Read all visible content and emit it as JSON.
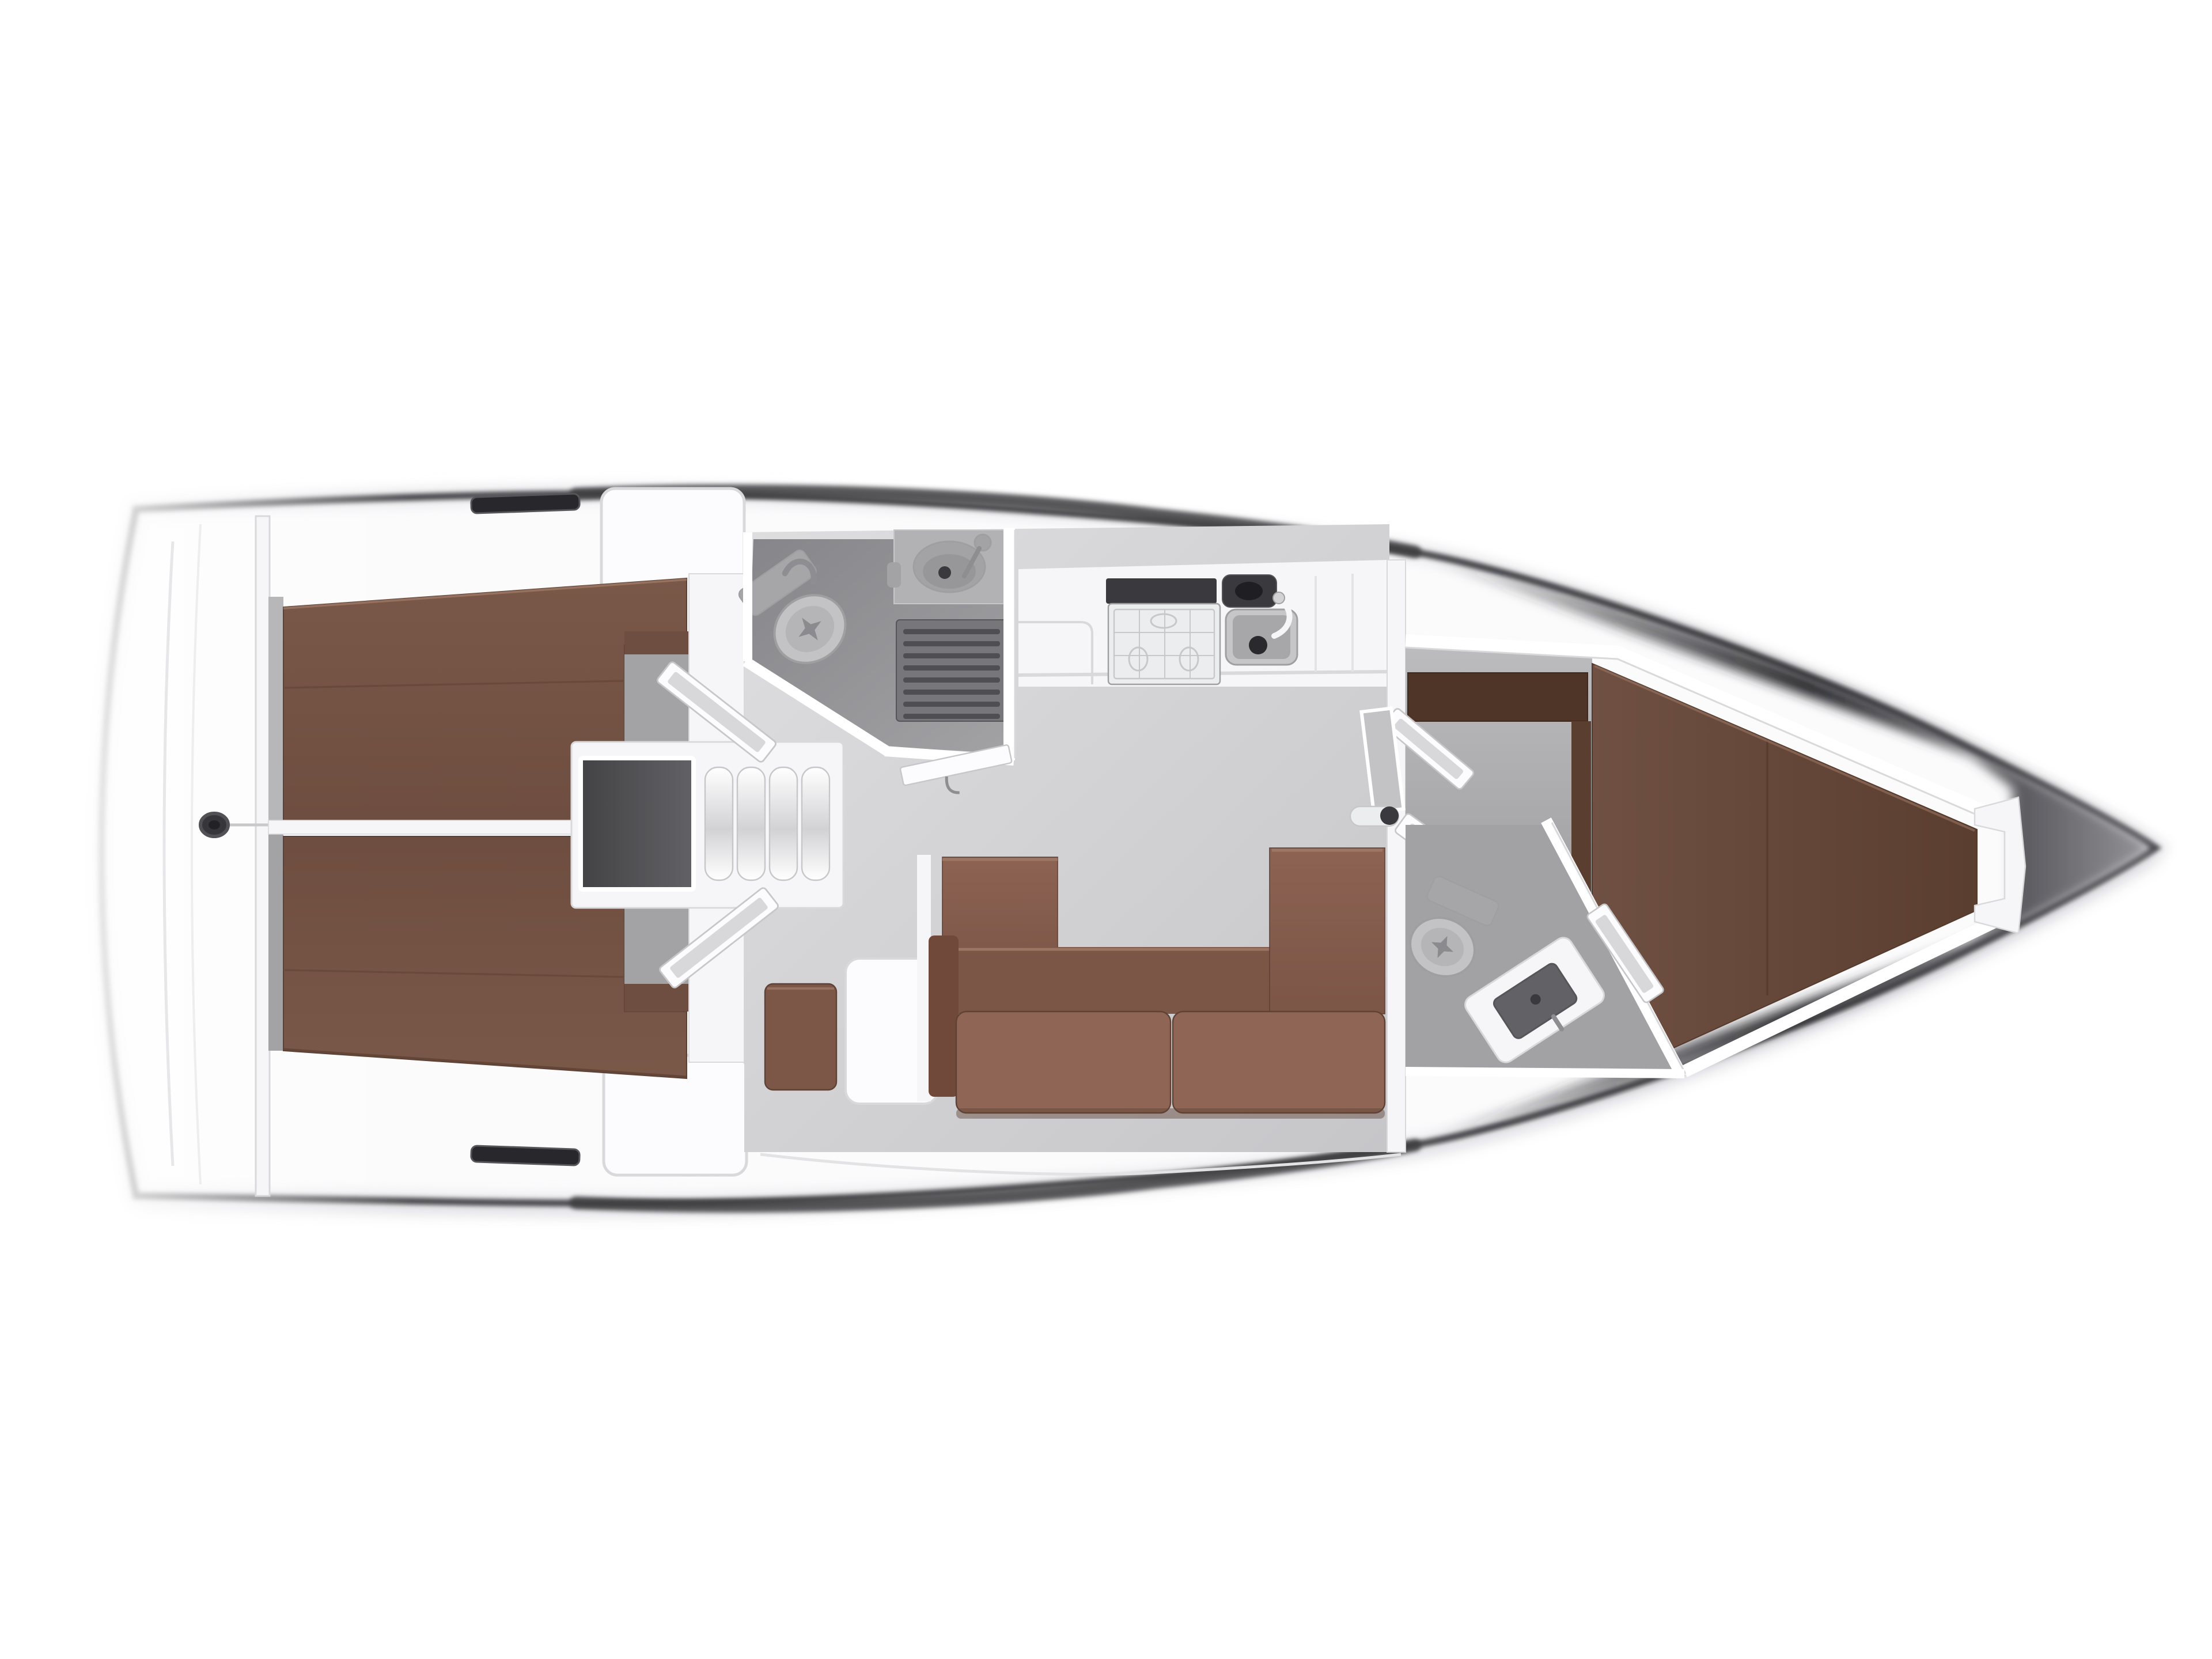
{
  "palette": {
    "background": "#ffffff",
    "hull_white": "#fbfbfc",
    "hull_inner_band": "#ebebee",
    "hull_outline": "#47474b",
    "rim_dark": "#3d3d41",
    "drop_shadow": "#2a2a2e",
    "bow_fade0": "#2b2b2f",
    "bow_dark": "#26262a",
    "bow_mid": "#55555a",
    "bow_tip": "#97979b",
    "deck_trim": "#d9d9dc",
    "deck_seam": "#e3e3e6",
    "slot_dark": "#28282c",
    "slot_edge": "#55555a",
    "floor_light": "#dedee0",
    "floor_dark": "#c6c6c9",
    "entrance_light": "#bcbcbf",
    "entrance_dark": "#8e8e91",
    "head_floor_dark": "#86868a",
    "head_floor_light": "#a2a2a5",
    "strip_gray_light": "#b7b7ba",
    "strip_gray_dark": "#a3a3a6",
    "upholstery_light": "#8d6353",
    "upholstery": "#7a5849",
    "upholstery_deep": "#6e4e40",
    "upholstery_dark": "#5f4236",
    "upholstery_seam": "#66483b",
    "upholstery_highlight": "#a37d69",
    "seat_face": "#8f6555",
    "seat_back": "#7b5546",
    "arm_brown": "#70493b",
    "nav_seat_brown": "#7c5748",
    "berth_fwd": "#6f5042",
    "berth_fwd_dark": "#5a3e30",
    "berth_fwd_seam": "#54392d",
    "wardrobe": "#4e3528",
    "wardrobe_edge": "#3e2a1f",
    "fixture_light": "#c3c3c5",
    "fixture_mid": "#b5b5b8",
    "fixture_gray": "#a6a6a9",
    "fixture_dark": "#8b8b8f",
    "fixture_line": "#9f9fa2",
    "counter_gray": "#b2b2b5",
    "basin_gray": "#a3a3a6",
    "basin_shade": "#979799",
    "grate_base": "#77777b",
    "grate_slat": "#4f4f53",
    "appliance_dark": "#3a3a3e",
    "appliance_hole": "#1f1f23",
    "stove_face": "#ecedef",
    "stove_line": "#c8c8cb",
    "sink_outer": "#c6c6c9",
    "sink_inner": "#a7a7aa",
    "drain_dark": "#2a2a2e",
    "engine_dark": "#434346",
    "engine_light": "#626266",
    "step_light": "#ffffff",
    "step_shade": "#d2d2d5",
    "white_trim": "#f6f6f8",
    "white_panel": "#fcfcfe",
    "trim_edge": "#c7c7ca",
    "glass": "#d8d8db",
    "mirror_glass": "#c3c3c6",
    "knob_dark": "#3a3a3e",
    "metal_gray": "#8e8e92",
    "platform_line": "#e7e7ea",
    "fitting_dark": "#37373b",
    "fitting_core": "#222226",
    "fitting_ring": "#515156",
    "centerline": "#c9c9cc"
  },
  "parts": [
    {
      "id": "hull",
      "label": "yacht-hull-top-view"
    },
    {
      "id": "swim-platform",
      "label": "stern-swim-platform"
    },
    {
      "id": "backstay-fitting",
      "label": "stern-deck-fitting"
    },
    {
      "id": "aft-cabin-port",
      "label": "aft-cabin-port-double-berth"
    },
    {
      "id": "aft-cabin-starboard",
      "label": "aft-cabin-starboard-double-berth"
    },
    {
      "id": "companionway",
      "label": "companionway-steps-and-engine-box"
    },
    {
      "id": "aft-head",
      "label": "aft-bathroom-with-shower"
    },
    {
      "id": "galley",
      "label": "galley-with-stove-and-sink"
    },
    {
      "id": "salon",
      "label": "salon-u-shaped-settee"
    },
    {
      "id": "nav-station",
      "label": "chart-table-and-seat"
    },
    {
      "id": "forward-head",
      "label": "forward-bathroom"
    },
    {
      "id": "forward-cabin",
      "label": "forward-v-berth-cabin"
    },
    {
      "id": "bow",
      "label": "bow-foredeck-cone"
    },
    {
      "id": "cockpit-lockers",
      "label": "deck-lockers"
    }
  ]
}
